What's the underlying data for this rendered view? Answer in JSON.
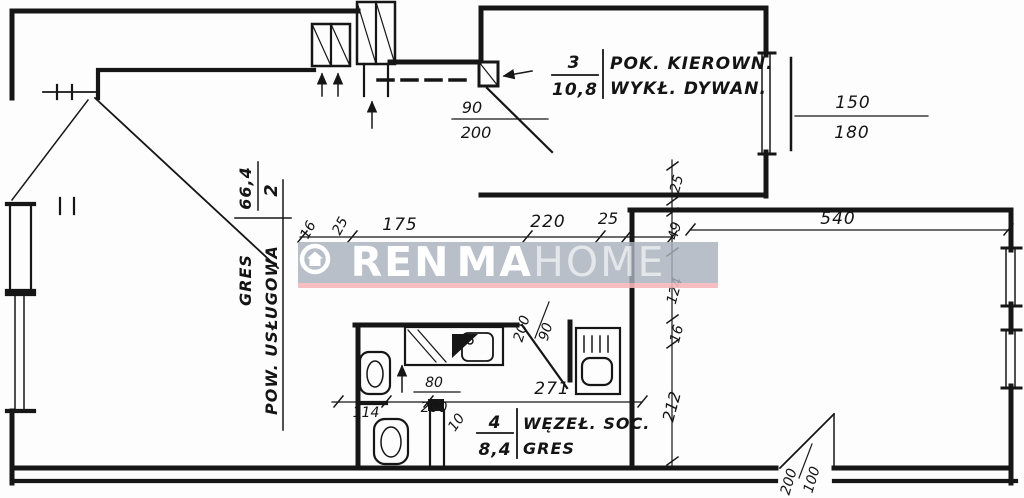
{
  "plan": {
    "rooms": {
      "room2": {
        "number": "2",
        "name": "POW. USŁUGOWA",
        "area": "66,4",
        "floor": "GRES"
      },
      "room3": {
        "number": "3",
        "name": "POK. KIEROWN.",
        "area": "10,8",
        "floor": "WYKŁ. DYWAN."
      },
      "room4": {
        "number": "4",
        "name": "WĘZEŁ. SOC.",
        "area": "8,4",
        "floor": "GRES"
      }
    },
    "dimensions": {
      "h_chain": [
        "16",
        "25",
        "175",
        "220",
        "25"
      ],
      "v_chain": [
        "25",
        "49",
        "124",
        "16",
        "212"
      ],
      "top_right_width": "540",
      "top_door": {
        "width": "90",
        "height": "200"
      },
      "right_window": {
        "width": "150",
        "height": "180"
      },
      "bath_door": {
        "width": "90",
        "height": "200"
      },
      "wc_door": {
        "width": "80",
        "height": "200"
      },
      "bath_width": "271",
      "wc_width": "114",
      "gap": "10",
      "bottom_door": {
        "width": "100",
        "height": "200"
      }
    }
  },
  "watermark": {
    "brand_left": "REN",
    "brand_right": "MA",
    "brand_suffix": "HOME",
    "house_icon": "house-in-circle",
    "band_color": "rgba(168,177,189,0.82)",
    "accent_color": "rgba(246,183,187,0.9)"
  },
  "colors": {
    "ink": "#161616",
    "paper": "#fdfdfd"
  }
}
